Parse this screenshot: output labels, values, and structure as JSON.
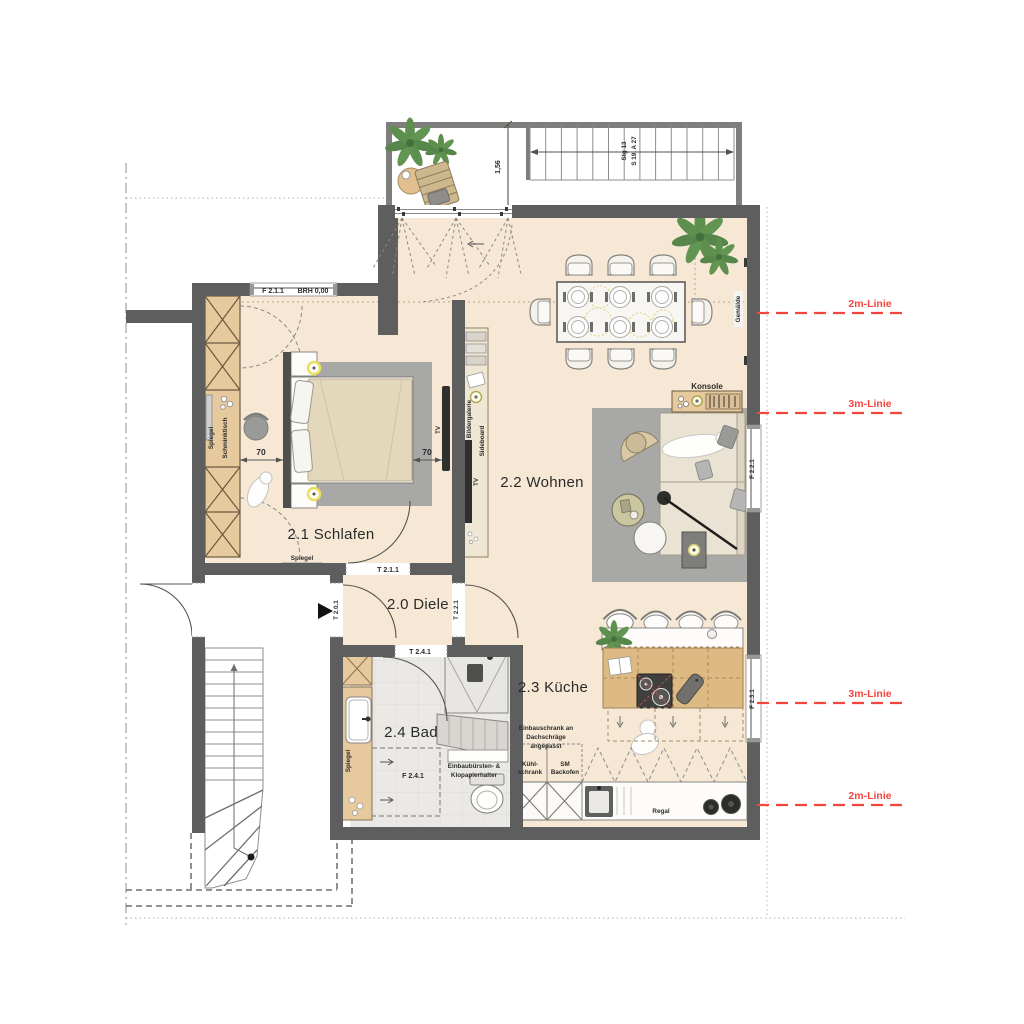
{
  "plan": {
    "rooms": {
      "schlafen": "2.1 Schlafen",
      "diele": "2.0 Diele",
      "wohnen": "2.2 Wohnen",
      "kueche": "2.3 Küche",
      "bad": "2.4 Bad"
    },
    "openings": {
      "f211": "F 2.1.1",
      "brh": "BRH 0,00",
      "t211": "T 2.1.1",
      "t201": "T 2.0.1",
      "t221": "T 2.2.1",
      "t241": "T 2.4.1",
      "f241": "F 2.4.1",
      "f221": "F 2.2.1",
      "f231": "F 2.3.1"
    },
    "labels": {
      "spiegel": "Spiegel",
      "schminktisch": "Schminktisch",
      "sideboard": "Sideboard",
      "bildergalerie": "Bildergalerie",
      "tv": "TV",
      "konsole": "Konsole",
      "gemaelde": "Gemälde",
      "regal": "Regal",
      "kuehl_1": "Kühl-",
      "kuehl_2": "schrank",
      "backofen_1": "SM",
      "backofen_2": "Backofen",
      "einbauschrank_1": "Einbauschrank an",
      "einbauschrank_2": "Dachschräge",
      "einbauschrank_3": "angepasst",
      "halter_1": "Einbaubürsten- &",
      "halter_2": "Klopapierhalter"
    },
    "dimensions": {
      "abstand_70": "70",
      "balkon_breite": "1,56",
      "treppe_1": "Stg 13",
      "treppe_2": "S 19, A 27"
    },
    "height_lines": {
      "line_2m": "2m-Linie",
      "line_3m": "3m-Linie"
    },
    "colors": {
      "wall": "#5e5e5e",
      "floor": "#f6e8d5",
      "wood": "#e7c99e",
      "island": "#ddb984",
      "tile": "#ebe9e6",
      "rug": "#a8a8a6",
      "red": "#f4453f",
      "plant": "#5d8f4e"
    }
  }
}
